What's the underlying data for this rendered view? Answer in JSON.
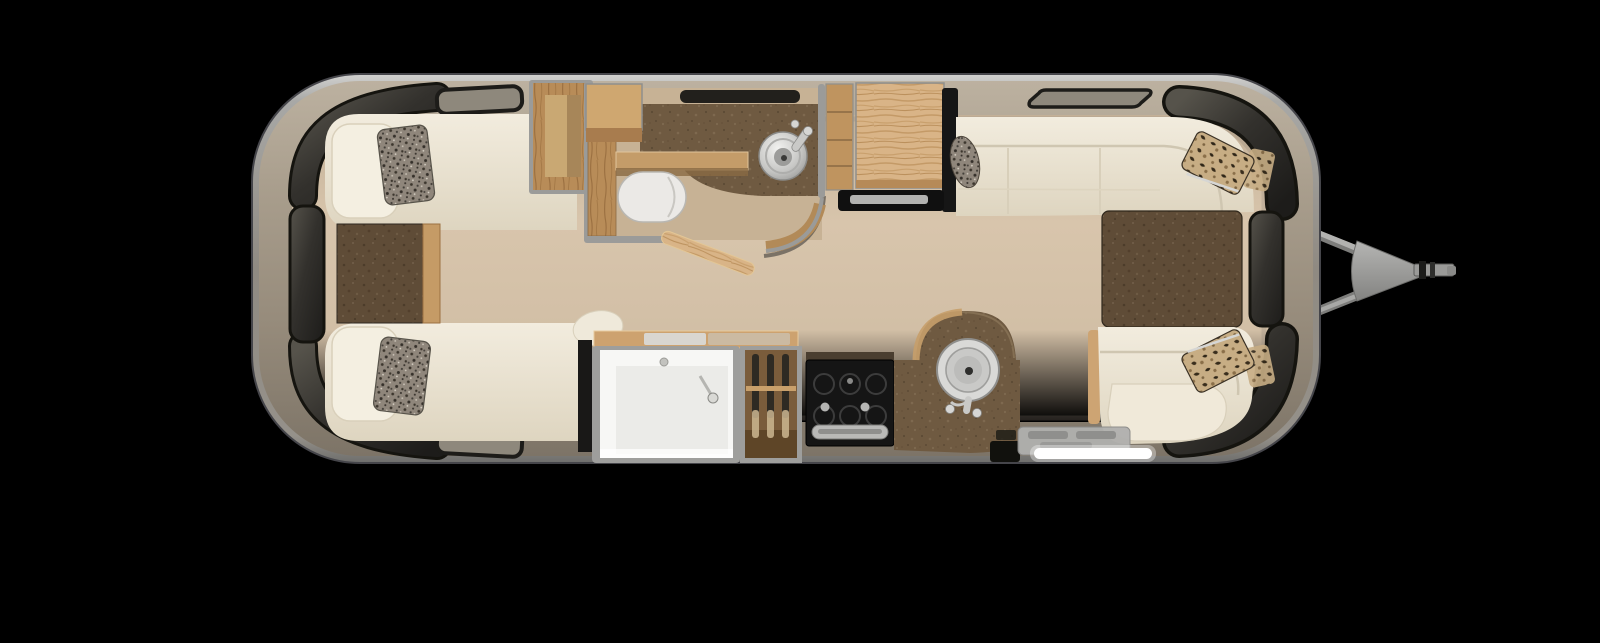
{
  "scene": {
    "kind": "travel-trailer-floorplan",
    "view": "top-down-3d-render",
    "orientation": "hitch-right-rear-left"
  },
  "colors": {
    "background": "#000000",
    "shell_rim": "#a9a9a7",
    "shell_outline": "#45454a",
    "wall_band": "#9c9183",
    "floor": "#d4c1a8",
    "bathroom_floor": "#c7b295",
    "upholstery_cream": "#ece5d3",
    "upholstery_shadow": "#d8cfba",
    "wood_light": "#d9b487",
    "wood_medium": "#b88c58",
    "counter_brown": "#6f5a41",
    "table_brown": "#5f4c37",
    "window_glass": "#2b2a27",
    "appliance_black": "#151515",
    "chrome": "#c9c9c7",
    "led_white": "#ffffff",
    "hitch_gray": "#9a9a98"
  },
  "rooms": [
    {
      "name": "rear-bedroom",
      "furniture": [
        "twin-bed-roadside",
        "twin-bed-curbside",
        "nightstand",
        "speckle-pillows",
        "wardrobe-bench"
      ]
    },
    {
      "name": "bathroom",
      "furniture": [
        "toilet",
        "round-lavatory-sink",
        "vanity-counter",
        "wood-shelf",
        "curved-wall",
        "open-door"
      ]
    },
    {
      "name": "galley-roadside",
      "furniture": [
        "pantry-shelves",
        "refrigerator-cabinet",
        "tv-panel"
      ]
    },
    {
      "name": "kitchen-curbside",
      "furniture": [
        "shower-stall",
        "broom-closet",
        "range-stove",
        "peninsula-counter",
        "round-kitchen-sink",
        "entry-step-led"
      ]
    },
    {
      "name": "front-lounge",
      "furniture": [
        "wraparound-sofa",
        "dinette-table",
        "dinette-bench",
        "leopard-pillows",
        "bolster-pillow"
      ]
    }
  ],
  "exterior": [
    "shell",
    "wrap-windows-rear",
    "wrap-windows-front",
    "roof-vents",
    "a-frame-hitch",
    "coupler"
  ]
}
